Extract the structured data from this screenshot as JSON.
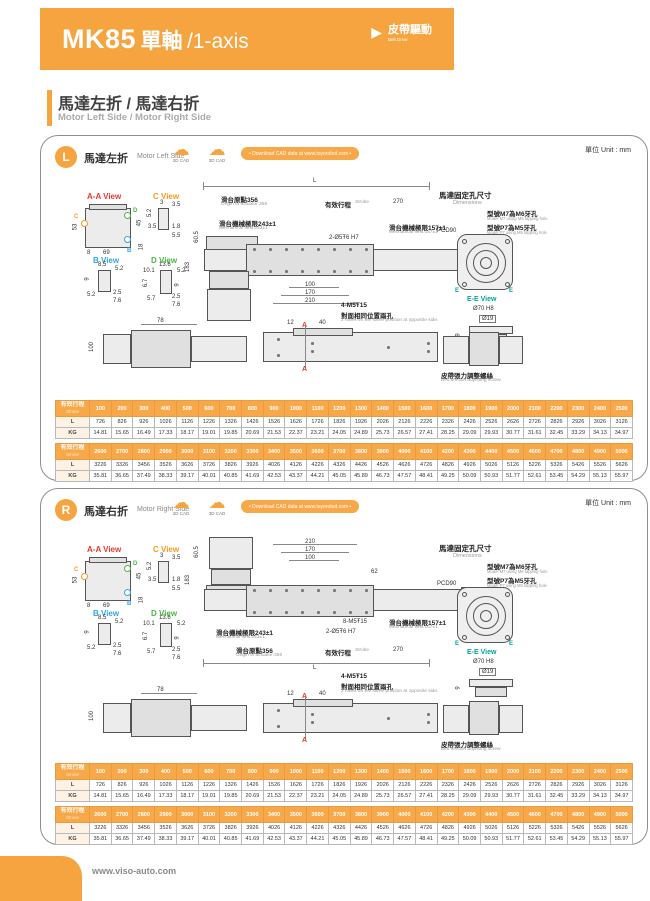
{
  "banner": {
    "model": "MK85",
    "axis_cn": "單軸",
    "axis_en": "/1-axis",
    "drive_cn": "皮帶驅動",
    "drive_en": "Belt Drive"
  },
  "section": {
    "title_cn": "馬達左折 / 馬達右折",
    "title_en": "Motor Left Side / Motor Right Side"
  },
  "footer": {
    "url": "www.viso-auto.com"
  },
  "colors": {
    "accent": "#F5A43F",
    "view_aa": "#E8392F",
    "view_c": "#F59B1E",
    "view_b": "#2FA8E0",
    "view_d": "#4CB648",
    "view_ee": "#00A59B"
  },
  "common": {
    "unit": "單位 Unit : mm",
    "cad_2d": "2D CAD",
    "cad_3d": "3D CAD",
    "download": "• Download CAD data at www.toyorobot.com •",
    "views": {
      "aa": "A-A View",
      "c": "C View",
      "b": "B View",
      "d": "D View",
      "ee": "E-E View"
    },
    "marks": {
      "a": "A",
      "b": "B",
      "c": "C",
      "d": "D",
      "e": "E"
    },
    "dims": {
      "l": "L",
      "d53": "53",
      "d45": "45",
      "d8": "8",
      "d69": "69",
      "d18": "18",
      "c3": "3",
      "c35": "3.5",
      "c52": "5.2",
      "c18": "1.8",
      "c55": "5.5",
      "b85": "8.5",
      "b52": "5.2",
      "b9": "9",
      "b25": "2.5",
      "b76": "7.6",
      "d136": "13.6",
      "d101": "10.1",
      "d52": "5.2",
      "d67": "6.7",
      "d9": "9",
      "d57": "5.7",
      "d25": "2.5",
      "d76": "7.6",
      "d605": "60.5",
      "d183": "183",
      "d85": "85",
      "d62": "62",
      "d270": "270",
      "d100": "100",
      "d170": "170",
      "d210": "210",
      "d78": "78",
      "d100v": "100",
      "d12": "12",
      "d40": "40",
      "d9s": "9",
      "d70": "Ø70 H8",
      "d19": "Ø19",
      "pcd": "PCD90"
    },
    "notes": {
      "origin_cn": "滑台原點356",
      "origin_en": "Origin of actuator:356",
      "stroke_cn": "有效行程",
      "stroke_en": "Stroke",
      "limit243_cn": "滑台機械極限243±1",
      "limit243_en": "Mechanical limit:243±1",
      "limit157_cn": "滑台機械極限157±1",
      "limit157_en": "Mechanical limit:157±1",
      "holes2": "2-Ø5Ŧ6 H7",
      "holes8": "8-M5Ŧ15",
      "holes4_cn": "4-M5Ŧ15",
      "holes4_cn2": "對面相同位置兩孔",
      "holes4_en": "2 holes on the same position at opposite side.",
      "motor_cn": "馬達固定孔尺寸",
      "motor_en": "Dimensions",
      "m7_cn": "型號M7為M6牙孔",
      "m7_en": "Model M7 using M6 tapping hole",
      "p7_cn": "型號P7為M5牙孔",
      "p7_en": "Model P7 using M5 tapping hole",
      "belt_cn": "皮帶張力調整螺絲",
      "belt_en": "Belt tension adjusting screw."
    }
  },
  "panels": [
    {
      "badge": "L",
      "title_cn": "馬達左折",
      "title_en": "Motor Left Side"
    },
    {
      "badge": "R",
      "title_cn": "馬達右折",
      "title_en": "Motor Right Side"
    }
  ],
  "table": {
    "header_cn": "有效行程",
    "header_en": "Stroke",
    "row_labels": [
      "L",
      "KG"
    ],
    "blocks": [
      {
        "strokes": [
          "100",
          "200",
          "300",
          "400",
          "500",
          "600",
          "700",
          "800",
          "900",
          "1000",
          "1100",
          "1200",
          "1300",
          "1400",
          "1500",
          "1600",
          "1700",
          "1800",
          "1900",
          "2000",
          "2100",
          "2200",
          "2300",
          "2400",
          "2500"
        ],
        "rows": [
          [
            "726",
            "826",
            "926",
            "1026",
            "1126",
            "1226",
            "1326",
            "1426",
            "1526",
            "1626",
            "1726",
            "1826",
            "1926",
            "2026",
            "2126",
            "2226",
            "2326",
            "2426",
            "2526",
            "2626",
            "2726",
            "2826",
            "2926",
            "3026",
            "3126"
          ],
          [
            "14.81",
            "15.65",
            "16.49",
            "17.33",
            "18.17",
            "19.01",
            "19.85",
            "20.69",
            "21.53",
            "22.37",
            "23.21",
            "24.05",
            "24.89",
            "25.73",
            "26.57",
            "27.41",
            "28.25",
            "29.09",
            "29.93",
            "30.77",
            "31.61",
            "32.45",
            "33.29",
            "34.13",
            "34.97"
          ]
        ]
      },
      {
        "strokes": [
          "2600",
          "2700",
          "2800",
          "2900",
          "3000",
          "3100",
          "3200",
          "3300",
          "3400",
          "3500",
          "3600",
          "3700",
          "3800",
          "3900",
          "4000",
          "4100",
          "4200",
          "4300",
          "4400",
          "4500",
          "4600",
          "4700",
          "4800",
          "4900",
          "5000"
        ],
        "rows": [
          [
            "3226",
            "3326",
            "3456",
            "3526",
            "3626",
            "3726",
            "3826",
            "3926",
            "4026",
            "4126",
            "4226",
            "4326",
            "4426",
            "4526",
            "4626",
            "4726",
            "4826",
            "4926",
            "5026",
            "5126",
            "5226",
            "5326",
            "5426",
            "5526",
            "5626"
          ],
          [
            "35.81",
            "36.65",
            "37.49",
            "38.33",
            "39.17",
            "40.01",
            "40.85",
            "41.69",
            "42.53",
            "43.37",
            "44.21",
            "45.05",
            "45.89",
            "46.73",
            "47.57",
            "48.41",
            "49.25",
            "50.09",
            "50.93",
            "51.77",
            "52.61",
            "53.45",
            "54.29",
            "55.13",
            "55.97"
          ]
        ]
      }
    ]
  }
}
